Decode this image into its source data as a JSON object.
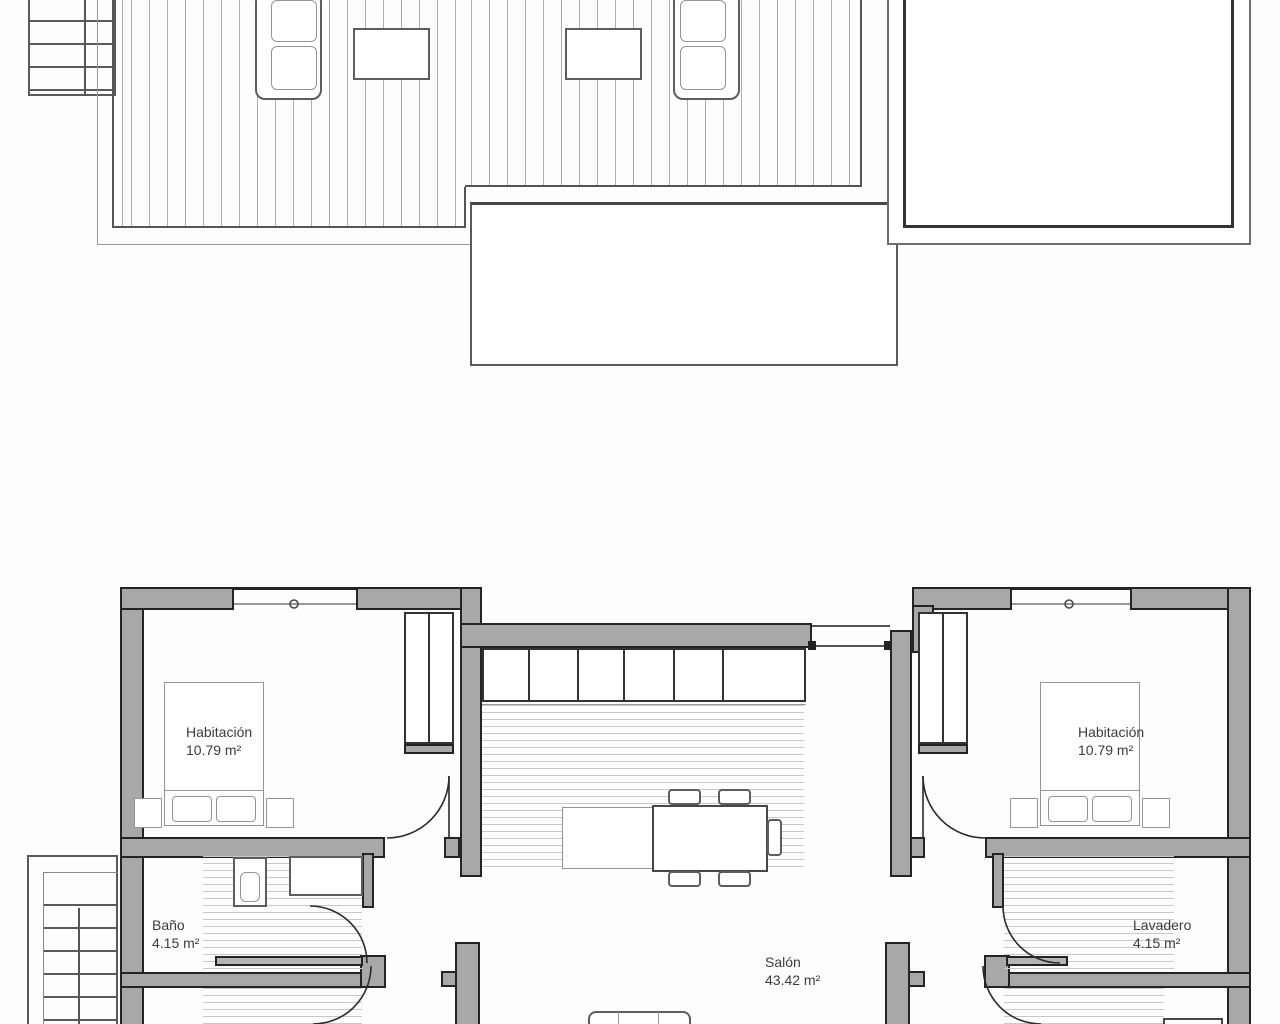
{
  "plan": {
    "rooms": {
      "bedroom_left": {
        "name": "Habitación",
        "area": "10.79 m²"
      },
      "bedroom_right": {
        "name": "Habitación",
        "area": "10.79 m²"
      },
      "bathroom": {
        "name": "Baño",
        "area": "4.15 m²"
      },
      "laundry": {
        "name": "Lavadero",
        "area": "4.15 m²"
      },
      "living_room": {
        "name": "Salón",
        "area": "43.42 m²"
      }
    },
    "colors": {
      "wall_fill": "#a8a8a8",
      "wall_outline": "#242424",
      "medium_line": "#5d5d5d",
      "light_line": "#adadad",
      "floor_stripe": "#c9c9c9",
      "label_text": "#3c3c3c",
      "background": "#fdfdfd"
    }
  }
}
